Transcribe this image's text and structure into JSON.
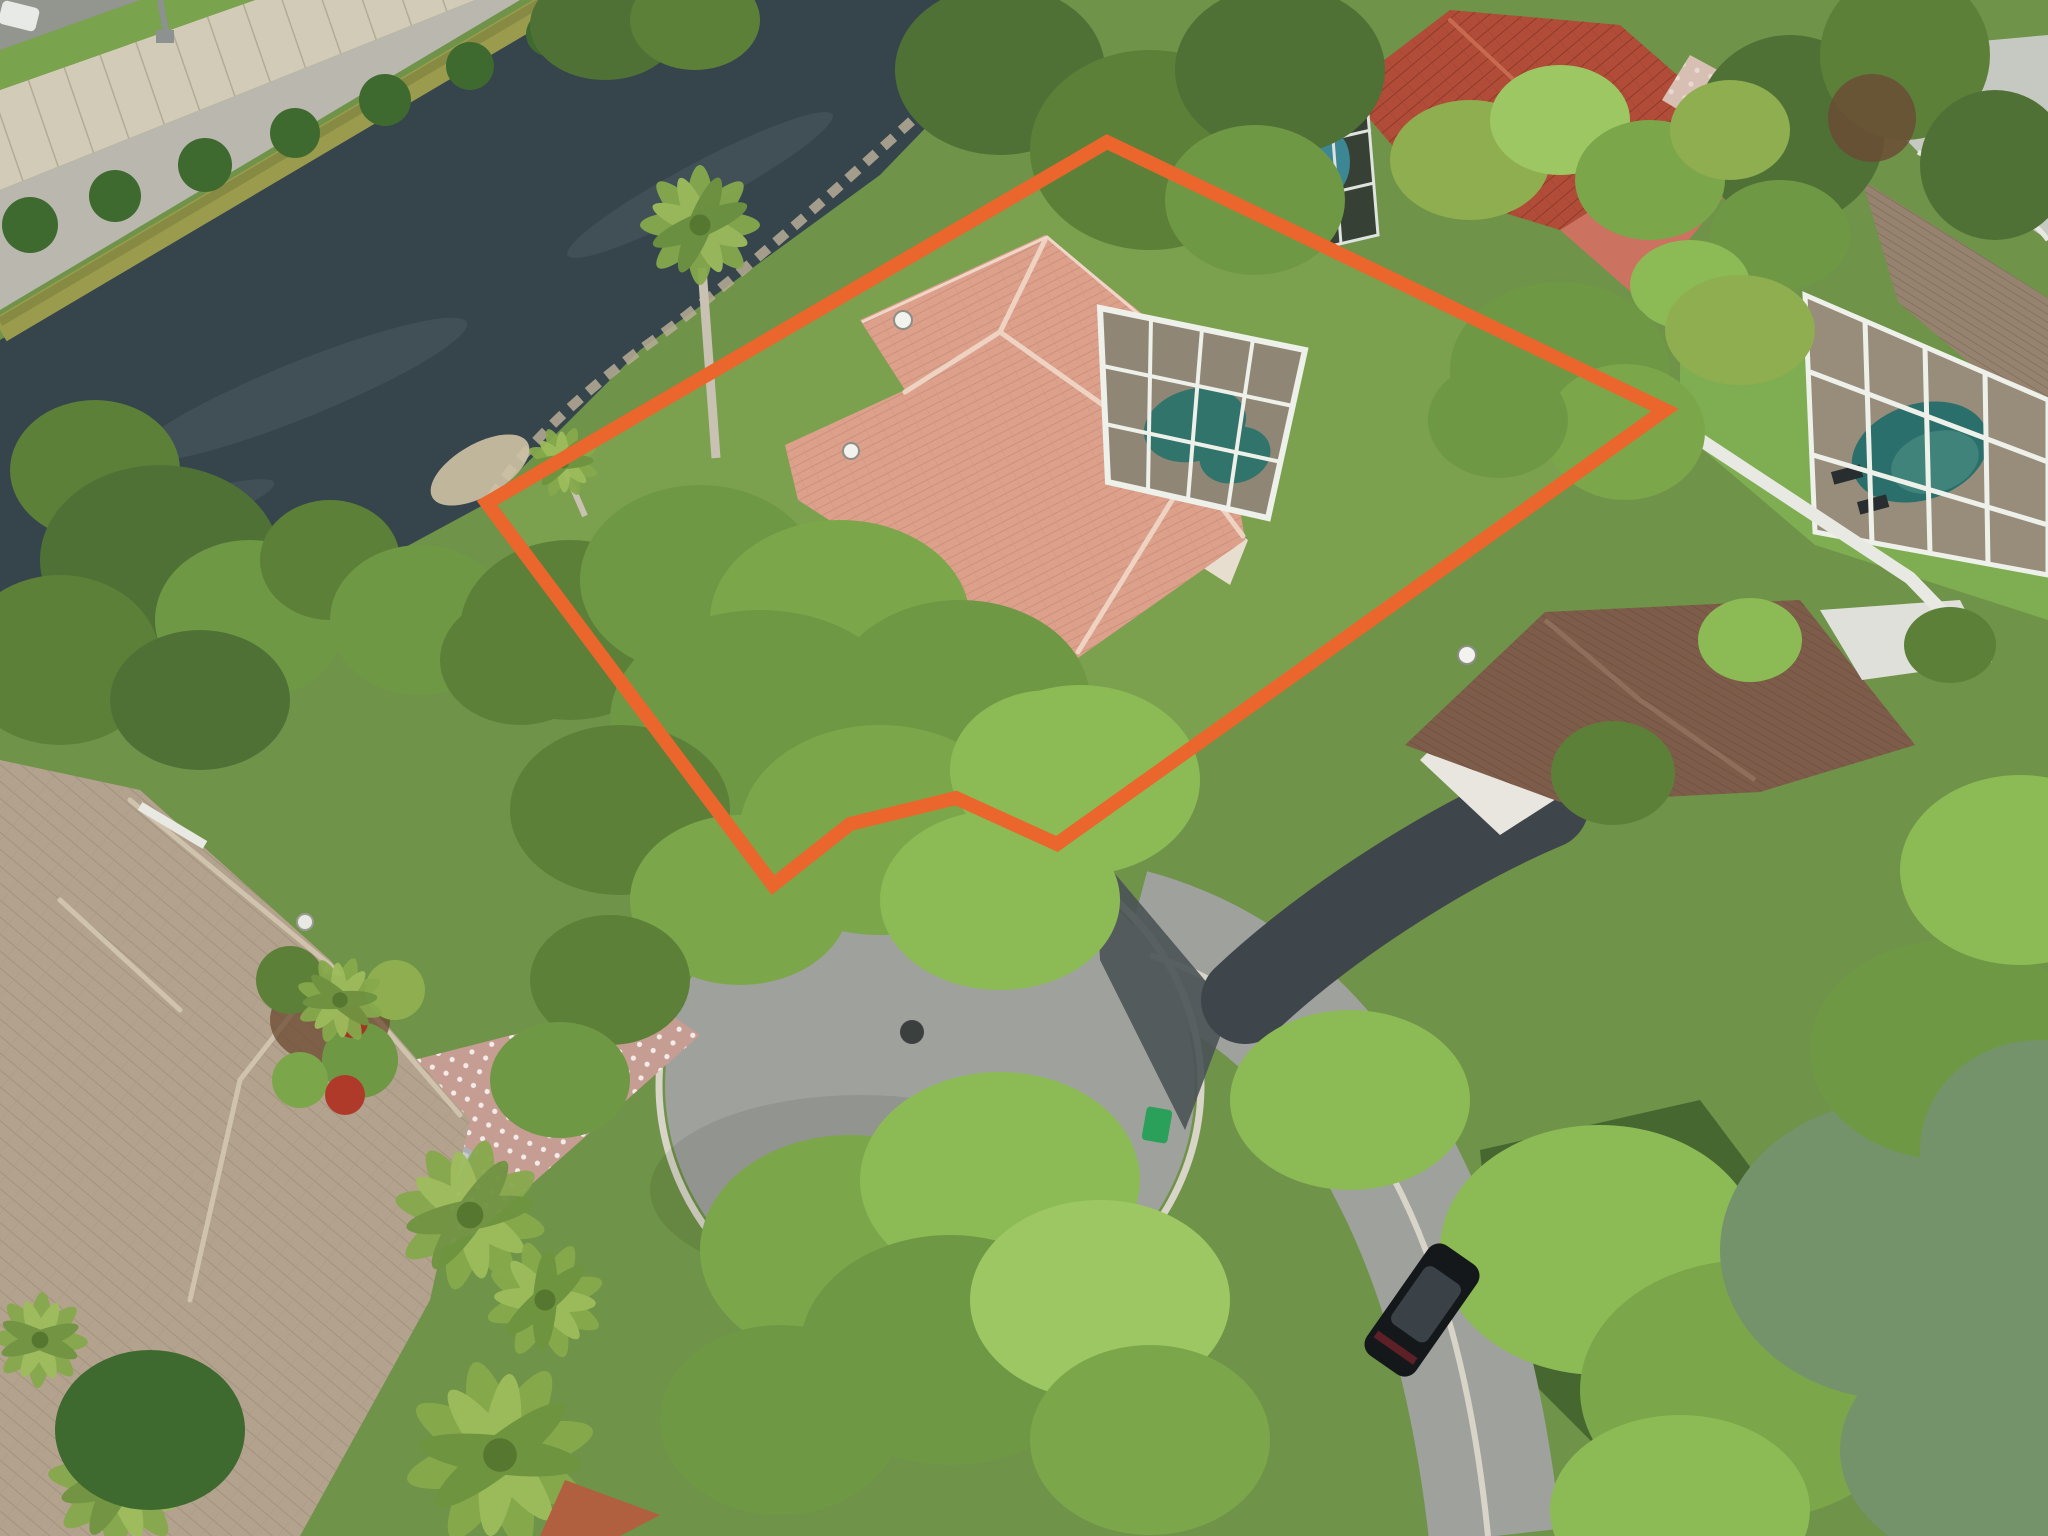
{
  "image": {
    "kind": "aerial-drone-real-estate-photo",
    "width_px": 2048,
    "height_px": 1536,
    "description": "Overhead drone view of a waterfront single-family lot on a cul-de-sac, outlined with an orange property-boundary polygon. A canal with a beige sound wall runs across the top-left; tile-roof houses with screened pool enclosures surround the cul-de-sac; dense tree canopy covers the lot frontage."
  },
  "annotation": {
    "boundary": {
      "label": "property-boundary-outline",
      "color": "#EA662C",
      "stroke_width": 14,
      "points": "487,503 1107,142 1665,410 1057,844 956,798 850,824 773,885"
    }
  },
  "palette": {
    "water": "#36444C",
    "water_streak": "#4D5C63",
    "moss_seawall": "#9A9B4D",
    "gravel": "#B9B7AE",
    "sound_wall": "#D2CBB8",
    "highway": "#93968F",
    "grass_base": "#6F9348",
    "lawn_subject": "#7BA14F",
    "lawn_bright": "#7FAE52",
    "lawn_dark": "#46672F",
    "roof_subject": "#DCA08B",
    "roof_red": "#B14C38",
    "wall_red_house": "#CB7260",
    "roof_brown": "#7D5C4A",
    "roof_ribbed_gray": "#96836F",
    "roof_tan": "#B3A28D",
    "roof_small_orange": "#B0603F",
    "pool_teal": "#3A9A8D",
    "pool_neighbor": "#2F8D85",
    "pool_blue": "#3E8FA0",
    "screen_dark": "#20262A",
    "deck_tan": "#C6B59C",
    "enclosure_frame": "#EEF0EA",
    "road": "#9FA19C",
    "road_sunlit": "#C6C9C2",
    "wet_asphalt": "#4A5357",
    "asphalt_drive": "#3E464B",
    "pavers": "#C59D92",
    "paver_patio": "#D8BFB4",
    "curb": "#D8D5C8",
    "fence_white": "#E9E9E4",
    "suv_silver": "#AAB0B4",
    "suv_black": "#15181B",
    "car_white": "#E8EAE8",
    "trash_bin_green": "#2AA05A",
    "manhole": "#3B3F3E",
    "palm_trunk": "#C9C2B2"
  },
  "objects": [
    {
      "name": "canal",
      "note": "dark water band, upper left"
    },
    {
      "name": "sound-wall",
      "note": "beige highway wall with bushes and gravel strip"
    },
    {
      "name": "highway-corner",
      "note": "top-left corner with white car and street light"
    },
    {
      "name": "subject-house",
      "note": "salmon tile hip roof, two satellite dishes"
    },
    {
      "name": "subject-pool-enclosure",
      "note": "white-frame screen cage, teal kidney pool"
    },
    {
      "name": "red-roof-house",
      "note": "top right, salmon walls, small screen cage"
    },
    {
      "name": "neighbor-pool-enclosure",
      "note": "large screen cage right edge, teal pool, loungers"
    },
    {
      "name": "brown-roof-house",
      "note": "right middle, satellite dish, black asphalt drive"
    },
    {
      "name": "tan-roof-house",
      "note": "bottom left, paver driveway, garden with red crotons and statue"
    },
    {
      "name": "cul-de-sac",
      "note": "gray asphalt circle, center manhole, wet streak"
    },
    {
      "name": "silver-suv",
      "note": "parked on paver driveway"
    },
    {
      "name": "black-suv",
      "note": "parked on street, bottom right"
    },
    {
      "name": "green-trash-bin",
      "note": "at curb east of circle"
    },
    {
      "name": "white-vinyl-fence",
      "note": "diagonal between lots on right"
    },
    {
      "name": "palms-and-canopy",
      "note": "tropical palms and large green tree canopy"
    }
  ]
}
